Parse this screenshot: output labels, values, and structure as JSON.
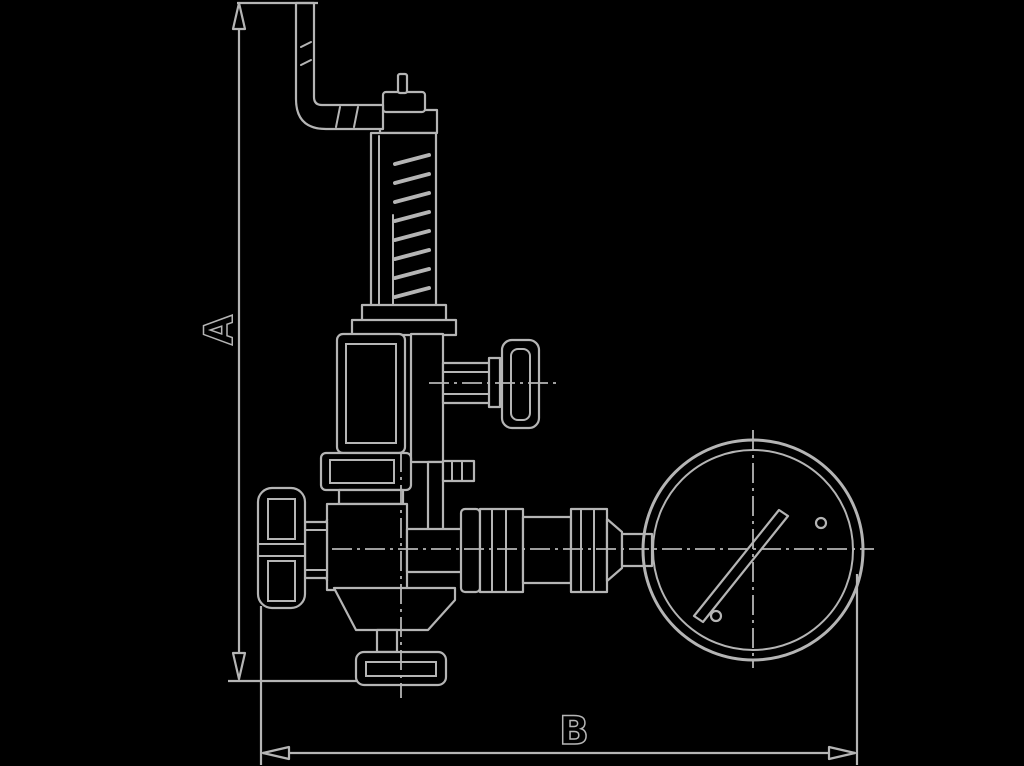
{
  "figure": {
    "type": "technical-drawing",
    "subject": "angle valve with lifting lever, handwheel and pressure gauge, dimensioned"
  },
  "labels": {
    "dimension_a": "A",
    "dimension_b": "B"
  },
  "colors": {
    "background": "#000000",
    "line": "#b5b5b5",
    "art_fill": "#000000"
  },
  "parts": [
    "lever-arm",
    "spindle-nut",
    "spring-column",
    "column-base-flange",
    "bonnet-box",
    "side-t-handle",
    "gland-flange",
    "handwheel",
    "valve-body",
    "outlet-skirt",
    "bottom-flange",
    "gauge-pipe",
    "pressure-gauge"
  ]
}
